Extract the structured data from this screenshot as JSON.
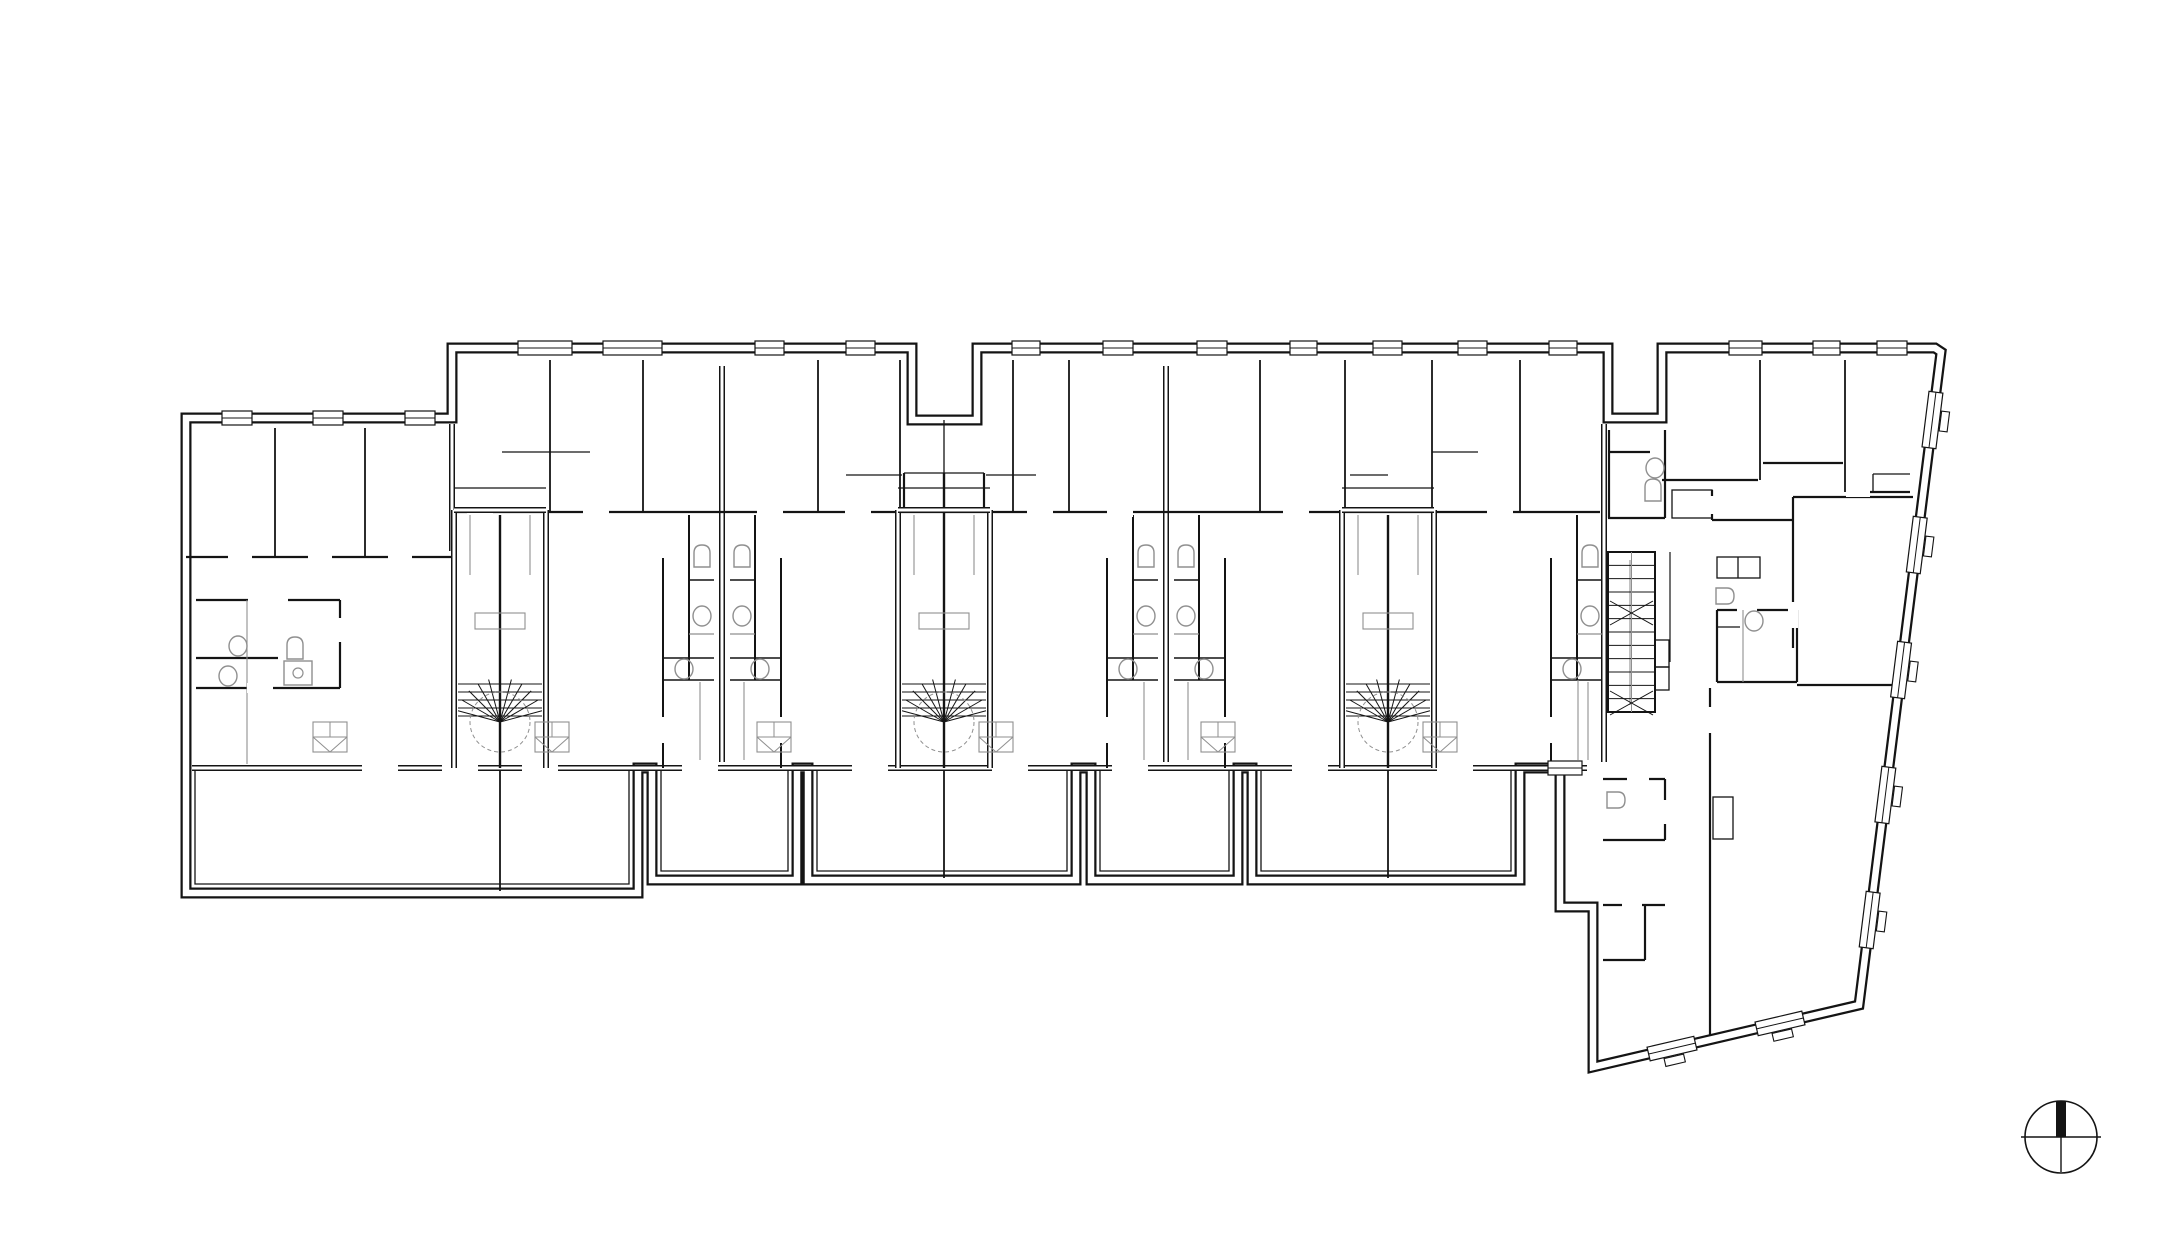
{
  "meta": {
    "drawing_type": "architectural-floor-plan",
    "canvas": {
      "w": 2182,
      "h": 1260
    },
    "colors": {
      "ink": "#141414",
      "gray": "#8f8f8f",
      "bg": "#ffffff"
    },
    "stroke": {
      "outerBlack": 11,
      "outerWhite": 6.5,
      "dblBlack": 6,
      "dblWhite": 3,
      "wall": 2.2,
      "thin": 1.3,
      "fix": 1.4
    }
  },
  "outline": [
    [
      186,
      418
    ],
    [
      452,
      418
    ],
    [
      452,
      348
    ],
    [
      912,
      348
    ],
    [
      912,
      420
    ],
    [
      977,
      420
    ],
    [
      977,
      348
    ],
    [
      1608,
      348
    ],
    [
      1608,
      418
    ],
    [
      1662,
      418
    ],
    [
      1662,
      348
    ],
    [
      1935,
      348
    ],
    [
      1941,
      352
    ],
    [
      1859,
      1005
    ],
    [
      1593,
      1067
    ],
    [
      1593,
      907
    ],
    [
      1560,
      907
    ],
    [
      1560,
      768
    ],
    [
      1520,
      768
    ],
    [
      1520,
      880
    ],
    [
      1252,
      880
    ],
    [
      1252,
      768
    ],
    [
      1238,
      768
    ],
    [
      1238,
      880
    ],
    [
      1091,
      880
    ],
    [
      1091,
      768
    ],
    [
      1076,
      768
    ],
    [
      1076,
      880
    ],
    [
      808,
      880
    ],
    [
      808,
      768
    ],
    [
      797,
      768
    ],
    [
      797,
      880
    ],
    [
      652,
      880
    ],
    [
      652,
      768
    ],
    [
      638,
      768
    ],
    [
      638,
      893
    ],
    [
      186,
      893
    ]
  ],
  "wallsDouble": [
    [
      192,
      768,
      1587,
      768
    ],
    [
      722,
      366,
      722,
      762
    ],
    [
      1166,
      366,
      1166,
      762
    ],
    [
      1604,
      424,
      1604,
      762
    ],
    [
      452,
      424,
      452,
      551
    ]
  ],
  "wallsSingle": [
    [
      452,
      512,
      1600,
      512
    ],
    [
      186,
      557,
      452,
      557
    ],
    [
      196,
      600,
      248,
      600
    ],
    [
      288,
      600,
      340,
      600
    ],
    [
      340,
      600,
      340,
      688
    ],
    [
      196,
      658,
      278,
      658
    ],
    [
      196,
      688,
      340,
      688
    ],
    [
      904,
      473,
      904,
      512
    ],
    [
      984,
      473,
      984,
      512
    ],
    [
      1662,
      480,
      1758,
      480
    ],
    [
      1763,
      463,
      1843,
      463
    ],
    [
      1847,
      492,
      1910,
      492
    ],
    [
      1793,
      497,
      1913,
      497
    ],
    [
      1793,
      497,
      1793,
      648
    ],
    [
      1712,
      520,
      1793,
      520
    ],
    [
      1712,
      490,
      1712,
      520
    ],
    [
      1609,
      430,
      1609,
      518
    ],
    [
      1665,
      430,
      1665,
      518
    ],
    [
      1608,
      518,
      1665,
      518
    ],
    [
      1610,
      452,
      1650,
      452
    ],
    [
      1717,
      610,
      1737,
      610
    ],
    [
      1757,
      610,
      1797,
      610
    ],
    [
      1797,
      610,
      1797,
      682
    ],
    [
      1717,
      682,
      1797,
      682
    ],
    [
      1717,
      610,
      1717,
      682
    ],
    [
      1797,
      685,
      1900,
      685
    ],
    [
      1710,
      688,
      1710,
      1035
    ],
    [
      1603,
      779,
      1665,
      779
    ],
    [
      1665,
      779,
      1665,
      800
    ],
    [
      1665,
      824,
      1665,
      840
    ],
    [
      1603,
      840,
      1665,
      840
    ],
    [
      1603,
      905,
      1665,
      905
    ],
    [
      1645,
      905,
      1645,
      960
    ],
    [
      1603,
      960,
      1645,
      960
    ]
  ],
  "wallsThin": [
    [
      502,
      452,
      590,
      452
    ],
    [
      1432,
      452,
      1478,
      452
    ],
    [
      846,
      475,
      902,
      475
    ],
    [
      986,
      475,
      1036,
      475
    ],
    [
      1350,
      475,
      1388,
      475
    ],
    [
      904,
      473,
      984,
      473
    ],
    [
      1873,
      474,
      1910,
      474
    ],
    [
      1873,
      474,
      1873,
      492
    ],
    [
      944,
      420,
      944,
      473
    ],
    [
      1738,
      557,
      1738,
      578
    ],
    [
      1717,
      627,
      1740,
      627
    ]
  ],
  "partitions": [
    [
      550,
      360,
      512
    ],
    [
      643,
      360,
      512
    ],
    [
      818,
      360,
      512
    ],
    [
      900,
      360,
      512
    ],
    [
      1013,
      360,
      512
    ],
    [
      1069,
      360,
      512
    ],
    [
      1260,
      360,
      512
    ],
    [
      1345,
      360,
      512
    ],
    [
      1432,
      360,
      512
    ],
    [
      1520,
      360,
      512
    ],
    [
      275,
      428,
      557
    ],
    [
      365,
      428,
      557
    ],
    [
      1760,
      360,
      480
    ],
    [
      1845,
      360,
      492
    ]
  ],
  "grayLines": [
    [
      247,
      600,
      247,
      764
    ],
    [
      1630,
      560,
      1630,
      705
    ],
    [
      1743,
      610,
      1743,
      682
    ],
    [
      1578,
      680,
      1578,
      760
    ]
  ],
  "rects": [
    {
      "x": 1717,
      "y": 557,
      "w": 43,
      "h": 21
    },
    {
      "x": 1672,
      "y": 490,
      "w": 40,
      "h": 28
    },
    {
      "x": 1713,
      "y": 797,
      "w": 20,
      "h": 42
    },
    {
      "x": 1655,
      "y": 640,
      "w": 14,
      "h": 27
    },
    {
      "x": 1655,
      "y": 667,
      "w": 14,
      "h": 23
    }
  ],
  "bathClusters": [
    {
      "b": 722,
      "sides": [
        -1,
        1
      ]
    },
    {
      "b": 1166,
      "sides": [
        -1,
        1
      ]
    },
    {
      "b": 1610,
      "sides": [
        -1
      ]
    }
  ],
  "leftBlockBath": {
    "sink": [
      [
        238,
        646
      ],
      [
        228,
        676
      ]
    ],
    "wc": [
      [
        295,
        648
      ]
    ],
    "shower": {
      "x": 284,
      "y": 661,
      "w": 28,
      "h": 24
    }
  },
  "fixtures": {
    "wcExtra": [
      [
        1653,
        490
      ]
    ],
    "sinkExtra": [
      [
        1655,
        468
      ],
      [
        1754,
        621
      ]
    ],
    "sinkDExtra": [
      [
        1725,
        596
      ],
      [
        1616,
        800
      ]
    ]
  },
  "apboxes": [
    [
      330,
      737
    ],
    [
      552,
      737
    ],
    [
      774,
      737
    ],
    [
      996,
      737
    ],
    [
      1218,
      737
    ],
    [
      1440,
      737
    ]
  ],
  "spirals": {
    "pws": [
      500,
      944,
      1388
    ],
    "top": 510,
    "bottom": 768,
    "half": 46,
    "treadsY": [
      684,
      692,
      700,
      708,
      716
    ],
    "fanCy": 722,
    "fanR": 44,
    "fanAngles": [
      195,
      210,
      225,
      240,
      255,
      270,
      285,
      300,
      315,
      330,
      345
    ],
    "landingY": 488,
    "grayRect": {
      "dx": -25,
      "y": 613,
      "w": 50,
      "h": 16
    },
    "railTop": 515,
    "railBot": 575,
    "railDx": 30
  },
  "straightStair": {
    "x1": 1608,
    "y1": 552,
    "x2": 1655,
    "y2": 712,
    "treads": 11,
    "xMarks": [
      613,
      703
    ]
  },
  "windows": [
    {
      "x": 518,
      "y": 348,
      "w": 54
    },
    {
      "x": 603,
      "y": 348,
      "w": 59
    },
    {
      "x": 755,
      "y": 348,
      "w": 29
    },
    {
      "x": 846,
      "y": 348,
      "w": 29
    },
    {
      "x": 1012,
      "y": 348,
      "w": 28
    },
    {
      "x": 1103,
      "y": 348,
      "w": 30
    },
    {
      "x": 1197,
      "y": 348,
      "w": 30
    },
    {
      "x": 1290,
      "y": 348,
      "w": 27
    },
    {
      "x": 1373,
      "y": 348,
      "w": 29
    },
    {
      "x": 1458,
      "y": 348,
      "w": 29
    },
    {
      "x": 1549,
      "y": 348,
      "w": 28
    },
    {
      "x": 1729,
      "y": 348,
      "w": 33
    },
    {
      "x": 1813,
      "y": 348,
      "w": 27
    },
    {
      "x": 1877,
      "y": 348,
      "w": 30
    },
    {
      "x": 222,
      "y": 418,
      "w": 30
    },
    {
      "x": 313,
      "y": 418,
      "w": 30
    },
    {
      "x": 405,
      "y": 418,
      "w": 30
    },
    {
      "x": 1548,
      "y": 768,
      "w": 34
    }
  ],
  "slantWindows": {
    "east": {
      "p1": [
        1941,
        352
      ],
      "p2": [
        1859,
        1005
      ],
      "centersY": [
        420,
        545,
        670,
        795,
        920
      ],
      "w": 56,
      "sill": -1
    },
    "bottom": {
      "p1": [
        1593,
        1067
      ],
      "p2": [
        1859,
        1005
      ],
      "centersX": [
        1672,
        1780
      ],
      "w": 48,
      "sill": 1
    }
  },
  "doors": [
    {
      "x": 380,
      "y": 768,
      "w": 36
    },
    {
      "x": 460,
      "y": 768,
      "w": 36
    },
    {
      "x": 540,
      "y": 768,
      "w": 36
    },
    {
      "x": 700,
      "y": 768,
      "w": 36
    },
    {
      "x": 870,
      "y": 768,
      "w": 36
    },
    {
      "x": 1010,
      "y": 768,
      "w": 36
    },
    {
      "x": 1130,
      "y": 768,
      "w": 36
    },
    {
      "x": 1310,
      "y": 768,
      "w": 36
    },
    {
      "x": 1455,
      "y": 768,
      "w": 36
    },
    {
      "x": 480,
      "y": 512,
      "w": 26
    },
    {
      "x": 596,
      "y": 512,
      "w": 26
    },
    {
      "x": 770,
      "y": 512,
      "w": 26
    },
    {
      "x": 858,
      "y": 512,
      "w": 26
    },
    {
      "x": 1040,
      "y": 512,
      "w": 26
    },
    {
      "x": 1120,
      "y": 512,
      "w": 26
    },
    {
      "x": 1296,
      "y": 512,
      "w": 26
    },
    {
      "x": 1500,
      "y": 512,
      "w": 26
    },
    {
      "x": 240,
      "y": 557,
      "w": 24
    },
    {
      "x": 320,
      "y": 557,
      "w": 24
    },
    {
      "x": 400,
      "y": 557,
      "w": 24
    },
    {
      "x": 260,
      "y": 688,
      "w": 26
    },
    {
      "x": 1690,
      "y": 497,
      "w": 26
    },
    {
      "x": 1773,
      "y": 497,
      "w": 26
    },
    {
      "x": 1858,
      "y": 492,
      "w": 24
    },
    {
      "x": 1638,
      "y": 779,
      "w": 22
    },
    {
      "x": 1632,
      "y": 905,
      "w": 20
    },
    {
      "x": 663,
      "y": 730,
      "w": 26,
      "vert": true
    },
    {
      "x": 781,
      "y": 730,
      "w": 26,
      "vert": true
    },
    {
      "x": 1107,
      "y": 730,
      "w": 26,
      "vert": true
    },
    {
      "x": 1225,
      "y": 730,
      "w": 26,
      "vert": true
    },
    {
      "x": 1551,
      "y": 730,
      "w": 26,
      "vert": true
    },
    {
      "x": 340,
      "y": 630,
      "w": 24,
      "vert": true
    },
    {
      "x": 1793,
      "y": 615,
      "w": 26,
      "vert": true
    },
    {
      "x": 1710,
      "y": 720,
      "w": 26,
      "vert": true
    },
    {
      "x": 1712,
      "y": 505,
      "w": 18,
      "vert": true
    }
  ],
  "terraces": [
    {
      "x1": 186,
      "x2": 638,
      "y2": 893,
      "div": 500
    },
    {
      "x1": 652,
      "x2": 797,
      "y2": 880
    },
    {
      "x1": 808,
      "x2": 1076,
      "y2": 880,
      "div": 944
    },
    {
      "x1": 1091,
      "x2": 1238,
      "y2": 880
    },
    {
      "x1": 1252,
      "x2": 1520,
      "y2": 880,
      "div": 1388
    }
  ],
  "compass": {
    "cx": 2061,
    "cy": 1137,
    "r": 36,
    "barW": 10,
    "barTop": 1101,
    "tailLen": 35,
    "hOver": 4
  }
}
